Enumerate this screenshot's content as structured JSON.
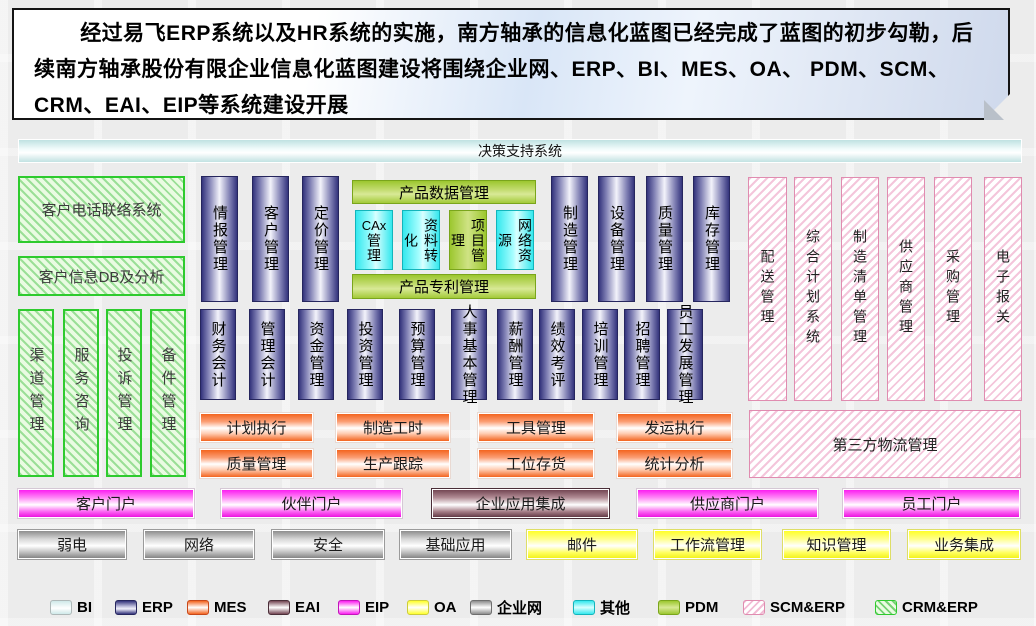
{
  "note": {
    "text": "经过易飞ERP系统以及HR系统的实施，南方轴承的信息化蓝图已经完成了蓝图的初步勾勒，后续南方轴承股份有限企业信息化蓝图建设将围绕企业网、ERP、BI、MES、OA、 PDM、SCM、CRM、EAI、EIP等系统建设开展"
  },
  "decision_bar": {
    "label": "决策支持系统"
  },
  "crm": {
    "boxes": [
      "客户电话联络系统",
      "客户信息DB及分析"
    ],
    "bars": [
      "渠道管理",
      "服务咨询",
      "投诉管理",
      "备件管理"
    ]
  },
  "erp_row1_left": [
    "情报管理",
    "客户管理",
    "定价管理"
  ],
  "pdm": {
    "top": "产品数据管理",
    "bottom": "产品专利管理",
    "cells": [
      {
        "latin": "CAx",
        "label": "管理",
        "type": "other"
      },
      {
        "label": "资料转化",
        "type": "other"
      },
      {
        "label": "项目管理",
        "type": "pdm"
      },
      {
        "label": "网络资源",
        "type": "other"
      }
    ]
  },
  "erp_row1_right": [
    "制造管理",
    "设备管理",
    "质量管理",
    "库存管理"
  ],
  "scm_bars": [
    "配送管理",
    "综合计划系统",
    "制造清单管理",
    "供应商管理",
    "采购管理",
    "电子报关"
  ],
  "erp_row2": [
    "财务会计",
    "管理会计",
    "资金管理",
    "投资管理",
    "预算管理",
    "人事基本管理",
    "薪酬管理",
    "绩效考评",
    "培训管理",
    "招聘管理",
    "员工发展管理"
  ],
  "mes": {
    "row1": [
      "计划执行",
      "制造工时",
      "工具管理",
      "发运执行"
    ],
    "row2": [
      "质量管理",
      "生产跟踪",
      "工位存货",
      "统计分析"
    ]
  },
  "logistics": {
    "label": "第三方物流管理"
  },
  "portals": [
    "客户门户",
    "伙伴门户",
    "企业应用集成",
    "供应商门户",
    "员工门户"
  ],
  "infra": [
    "弱电",
    "网络",
    "安全",
    "基础应用",
    "邮件",
    "工作流管理",
    "知识管理",
    "业务集成"
  ],
  "legend": [
    {
      "label": "BI"
    },
    {
      "label": "ERP"
    },
    {
      "label": "MES"
    },
    {
      "label": "EAI"
    },
    {
      "label": "EIP"
    },
    {
      "label": "OA"
    },
    {
      "label": "企业网"
    },
    {
      "label": "其他"
    },
    {
      "label": "PDM"
    },
    {
      "label": "SCM&ERP"
    },
    {
      "label": "CRM&ERP"
    }
  ],
  "colors": {
    "bi": "#cfe9e9",
    "erp": "#34347c",
    "mes": "#f3641f",
    "eai": "#744653",
    "eip": "#fb1ef0",
    "oa": "#ffff2a",
    "net": "#8d8d8d",
    "other": "#35e8ee",
    "pdm": "#9cc72f",
    "scm_hatch": "#eca0c3",
    "crm_hatch": "#5ac85a"
  }
}
